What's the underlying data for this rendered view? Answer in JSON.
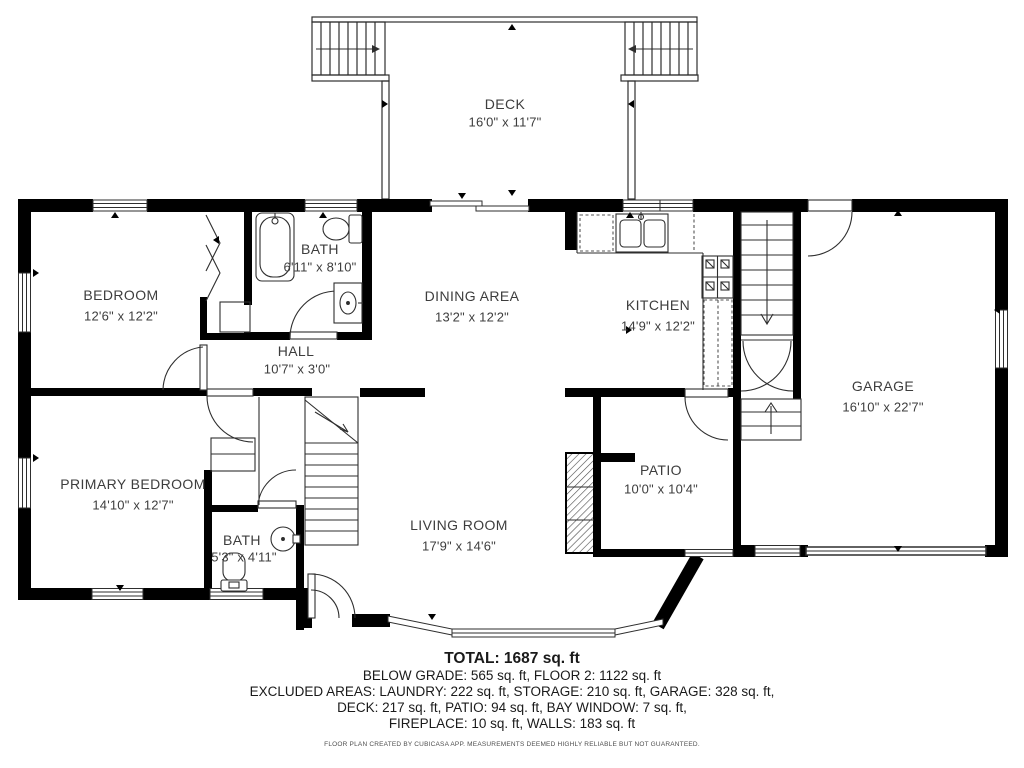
{
  "title": "Floor plan",
  "colors": {
    "wall": "#000000",
    "thin_line": "#2e2e2e",
    "room_label": "#3d3d3d",
    "footer_text": "#1a1a1a",
    "disclaimer_text": "#4f4f4f",
    "background": "#ffffff"
  },
  "rooms": {
    "deck": {
      "name": "DECK",
      "dims": "16'0\" x 11'7\""
    },
    "bedroom": {
      "name": "BEDROOM",
      "dims": "12'6\" x 12'2\""
    },
    "bath_upper": {
      "name": "BATH",
      "dims": "6'11\" x 8'10\""
    },
    "dining": {
      "name": "DINING AREA",
      "dims": "13'2\" x 12'2\""
    },
    "kitchen": {
      "name": "KITCHEN",
      "dims": "14'9\" x 12'2\""
    },
    "garage": {
      "name": "GARAGE",
      "dims": "16'10\" x 22'7\""
    },
    "hall": {
      "name": "HALL",
      "dims": "10'7\" x 3'0\""
    },
    "primary_bedroom": {
      "name": "PRIMARY BEDROOM",
      "dims": "14'10\" x 12'7\""
    },
    "bath_lower": {
      "name": "BATH",
      "dims": "5'3\" x 4'11\""
    },
    "living_room": {
      "name": "LIVING ROOM",
      "dims": "17'9\" x 14'6\""
    },
    "patio": {
      "name": "PATIO",
      "dims": "10'0\" x 10'4\""
    }
  },
  "summary": {
    "total": "TOTAL: 1687 sq. ft",
    "below_grade": "BELOW GRADE: 565 sq. ft, FLOOR 2: 1122 sq. ft",
    "excluded_1": "EXCLUDED AREAS: LAUNDRY: 222 sq. ft, STORAGE: 210 sq. ft, GARAGE: 328 sq. ft,",
    "excluded_2": "DECK: 217 sq. ft, PATIO: 94 sq. ft, BAY WINDOW: 7 sq. ft,",
    "excluded_3": "FIREPLACE: 10 sq. ft, WALLS: 183 sq. ft",
    "disclaimer": "FLOOR PLAN CREATED BY CUBICASA APP. MEASUREMENTS DEEMED HIGHLY RELIABLE BUT NOT GUARANTEED."
  }
}
